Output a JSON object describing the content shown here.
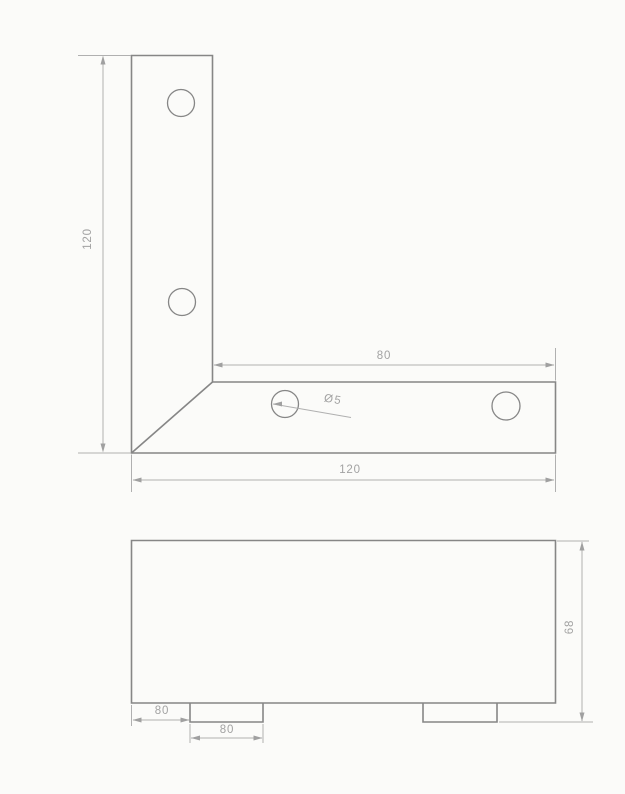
{
  "labels": {
    "top_view_leg_length_vertical": "120",
    "top_view_inner_length": "80",
    "top_view_overall_width": "120",
    "top_view_hole_diameter": "Ø5",
    "front_view_left_offset": "80",
    "front_view_tab_width": "80",
    "front_view_height": "68"
  },
  "drawing": {
    "style": {
      "background": "#fbfbf9",
      "outline_color": "#868686",
      "outline_width": 1.6,
      "hole_stroke_width": 1.3,
      "thin_color": "#b0b0b0",
      "thin_width": 1,
      "arrow_color": "#a0a0a0",
      "arrow_length": 9,
      "arrow_half_width": 2.5,
      "text_color": "#a2a2a2"
    },
    "views": [
      {
        "name": "top-view-angle-bracket",
        "outline_paths": [
          "M131.5,55.5 L212.5,55.5 L212.5,382 L555.5,382 L555.5,453 L131.5,453 Z",
          "M212.5,382 L131.5,453"
        ],
        "holes": [
          {
            "cx": 181,
            "cy": 103,
            "r": 13.5
          },
          {
            "cx": 182,
            "cy": 302,
            "r": 13.5
          },
          {
            "cx": 285,
            "cy": 404,
            "r": 13.5
          },
          {
            "cx": 506,
            "cy": 406,
            "r": 14
          }
        ],
        "thin_lines": [
          [
            78,
            55.5,
            131,
            55.5
          ],
          [
            78,
            453,
            131,
            453
          ],
          [
            103,
            57,
            103,
            451
          ],
          [
            214,
            365,
            554,
            365
          ],
          [
            555.5,
            348,
            555.5,
            380.5
          ],
          [
            555.5,
            454.5,
            555.5,
            492
          ],
          [
            131.5,
            454.5,
            131.5,
            492
          ],
          [
            133,
            480,
            554,
            480
          ],
          [
            273,
            404,
            351,
            417.5
          ]
        ],
        "arrows": [
          {
            "tip": [
              103,
              55.5
            ],
            "dir": "up"
          },
          {
            "tip": [
              103,
              452.5
            ],
            "dir": "down"
          },
          {
            "tip": [
              213.5,
              365
            ],
            "dir": "left"
          },
          {
            "tip": [
              554.5,
              365
            ],
            "dir": "right"
          },
          {
            "tip": [
              132.5,
              480
            ],
            "dir": "left"
          },
          {
            "tip": [
              554.5,
              480
            ],
            "dir": "right"
          },
          {
            "tip": [
              273,
              404
            ],
            "dir": "left"
          }
        ]
      },
      {
        "name": "front-view-angle-bracket",
        "outline_paths": [
          "M131.5,540.5 L555.5,540.5 L555.5,703 L131.5,703 Z",
          "M190,703 L190,722 L263,722 L263,703",
          "M423,703 L423,722 L497,722 L497,703"
        ],
        "holes": [],
        "thin_lines": [
          [
            131.5,
            705,
            131.5,
            726
          ],
          [
            133,
            720,
            189,
            720
          ],
          [
            190,
            724,
            190,
            743
          ],
          [
            263,
            724,
            263,
            743
          ],
          [
            191,
            738,
            262,
            738
          ],
          [
            557,
            541,
            589,
            541
          ],
          [
            499,
            722,
            593,
            722
          ],
          [
            582,
            542,
            582,
            721
          ]
        ],
        "arrows": [
          {
            "tip": [
              132.5,
              720
            ],
            "dir": "left"
          },
          {
            "tip": [
              189.5,
              720
            ],
            "dir": "right"
          },
          {
            "tip": [
              191,
              738
            ],
            "dir": "left"
          },
          {
            "tip": [
              262.5,
              738
            ],
            "dir": "right"
          },
          {
            "tip": [
              582,
              541.5
            ],
            "dir": "up"
          },
          {
            "tip": [
              582,
              721.5
            ],
            "dir": "down"
          }
        ]
      }
    ]
  }
}
